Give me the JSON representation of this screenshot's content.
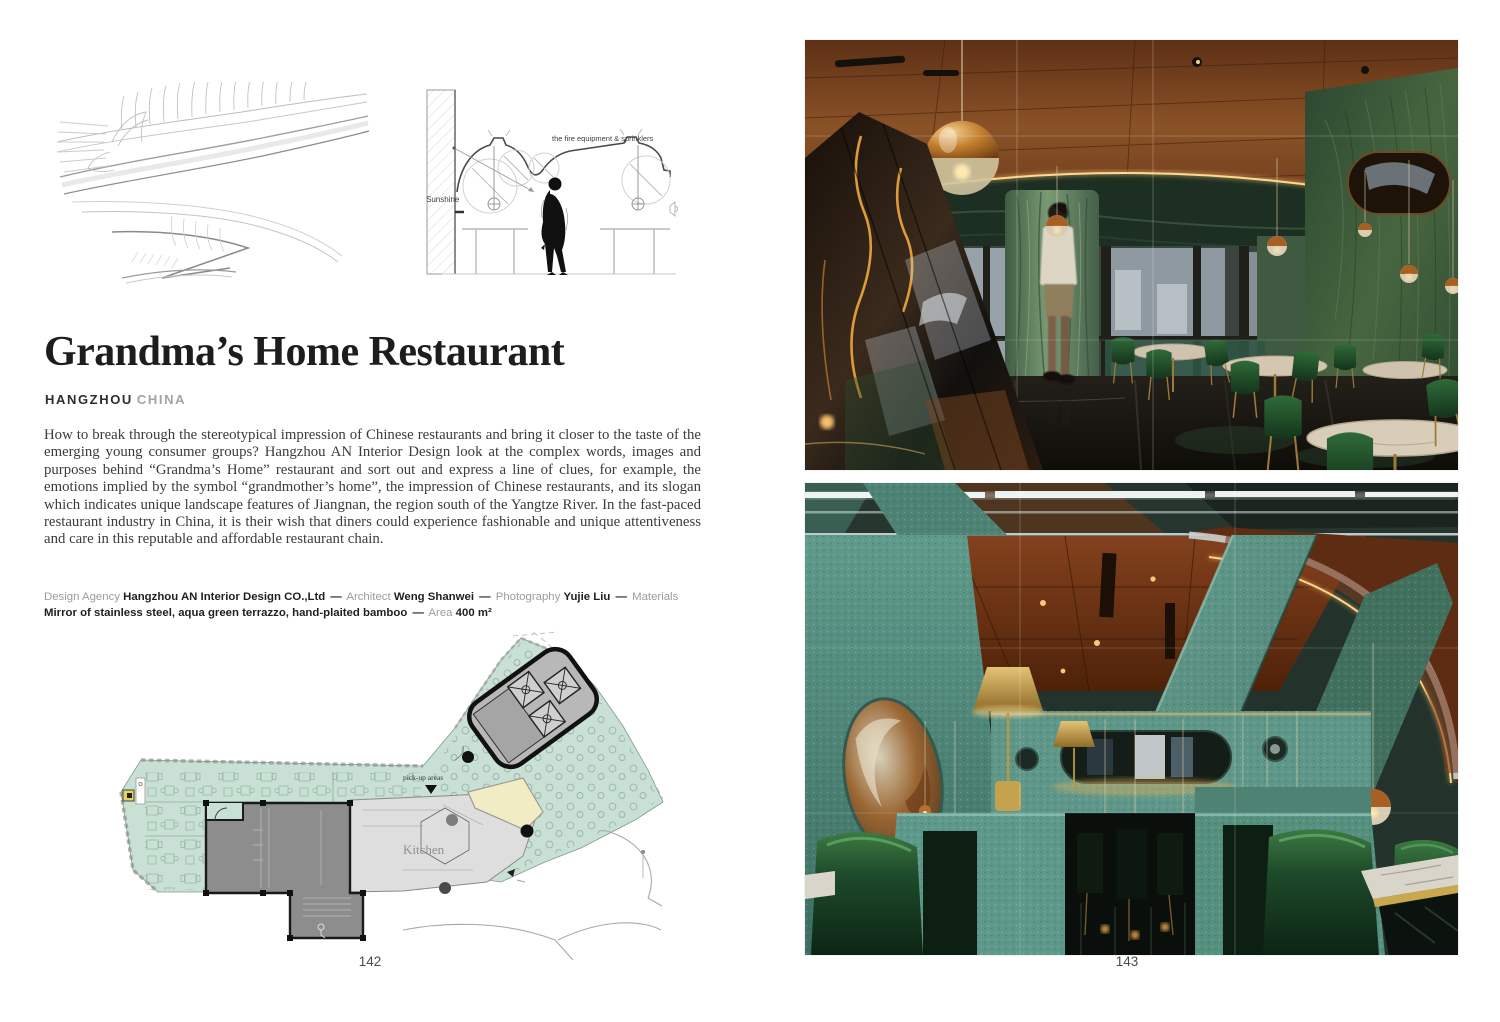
{
  "left_page": {
    "title": "Grandma’s Home Restaurant",
    "location_city": "HANGZHOU",
    "location_country": "CHINA",
    "body": "How to break through the stereotypical impression of Chinese restaurants and bring it closer to the taste of the emerging young consumer groups? Hangzhou AN Interior Design look at the complex words, images and purposes behind “Grandma’s Home” restaurant and sort out and express a line of clues, for example, the emotions implied by the symbol “grandmother’s home”, the impression of Chinese restaurants, and its slogan which indicates unique landscape features of Jiangnan, the region south of the Yangtze River. In the fast-paced restaurant industry in China, it is their wish that diners could experience fashionable and unique attentiveness and care in this reputable and affordable restaurant chain.",
    "credits_separator": "—",
    "credits": [
      {
        "label": "Design Agency ",
        "value": "Hangzhou AN Interior Design CO.,Ltd"
      },
      {
        "label": "Architect ",
        "value": "Weng Shanwei"
      },
      {
        "label": "Photography ",
        "value": "Yujie Liu"
      },
      {
        "label": "Materials ",
        "value": "Mirror of stainless steel, aqua green terrazzo, hand-plaited bamboo"
      },
      {
        "label": "Area ",
        "value": "400 m²"
      }
    ],
    "section_diagram": {
      "label_top": "the fire equipment & sprinklers",
      "label_left": "Sunshine"
    },
    "floor_plan": {
      "kitchen_label": "Kitchen",
      "pickup_label": "pick-up areas"
    },
    "page_number": "142"
  },
  "right_page": {
    "page_number": "143",
    "photos": [
      {
        "name": "dining-room-photo"
      },
      {
        "name": "booth-seating-photo"
      }
    ]
  },
  "colors": {
    "plan_green": "#c9e1d4",
    "plan_gray_dark": "#8d8d8d",
    "plan_gray_light": "#dedede",
    "plan_cream": "#f1ecc4",
    "photo_copper": "#7a3c1c",
    "photo_teal": "#4f8678",
    "photo_leather_green": "#1d4a2a",
    "photo_gold": "#d9a355"
  }
}
